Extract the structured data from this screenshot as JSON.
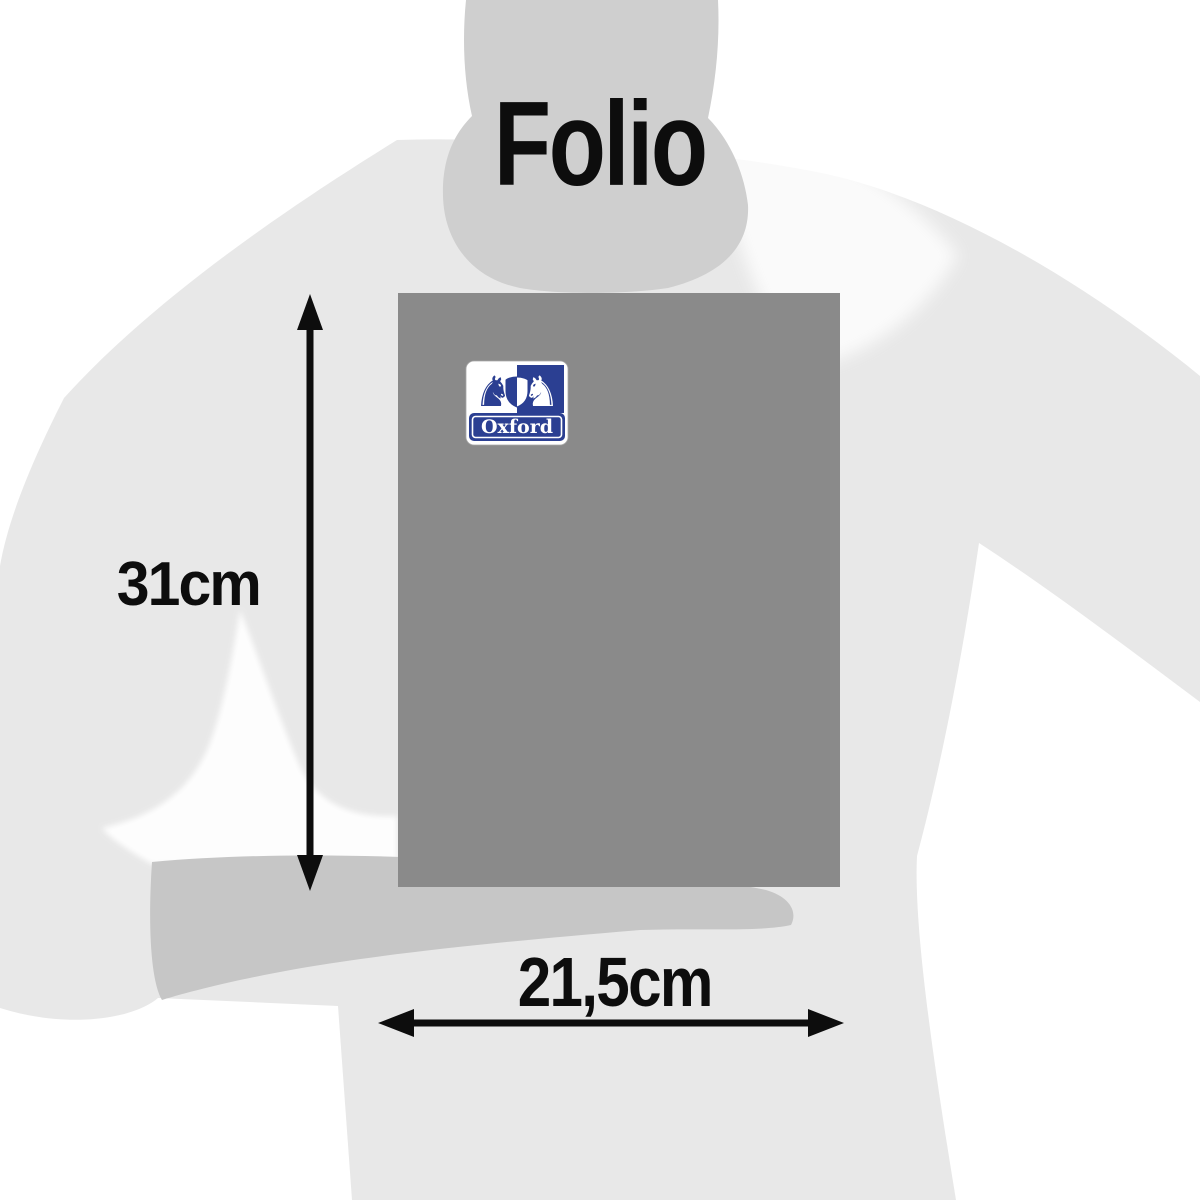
{
  "page": {
    "title": "Folio"
  },
  "product": {
    "name": "Folio notebook size illustration",
    "brand": "Oxford",
    "height": "31cm",
    "width": "21,5cm"
  },
  "icons": {
    "lion": "♞"
  },
  "colors": {
    "background": "#ffffff",
    "body": "#e8e8e8",
    "head": "#cfcfcf",
    "forearm": "#c6c6c6",
    "notebook": "#8a8a8a",
    "logo_blue": "#2b3f92",
    "logo_white": "#ffffff",
    "ink": "#0d0d0d"
  }
}
